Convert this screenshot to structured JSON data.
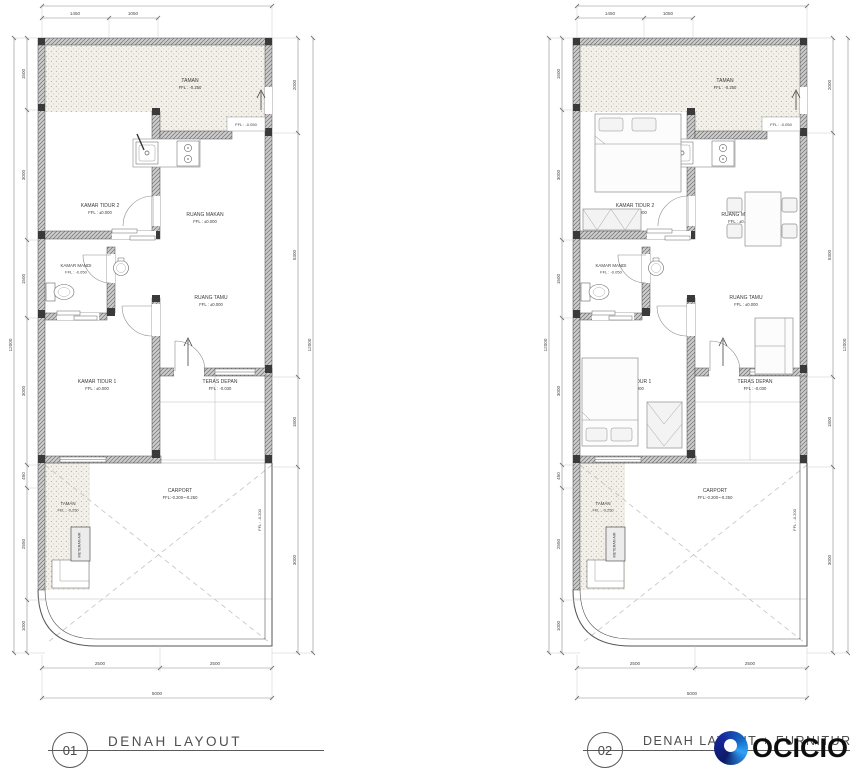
{
  "titles": {
    "plan1": {
      "number": "01",
      "label": "DENAH LAYOUT"
    },
    "plan2": {
      "number": "02",
      "label": "DENAH LAYOUT + FURNITURE"
    }
  },
  "rooms": {
    "taman_rear": {
      "name": "TAMAN",
      "ffl": "FFL : -0.250"
    },
    "kitchen": {
      "ffl_badge": "FFL : -0.050"
    },
    "kamar_tidur_2": {
      "name": "KAMAR TIDUR 2",
      "ffl": "FFL : ±0.000"
    },
    "ruang_makan": {
      "name": "RUANG MAKAN",
      "ffl": "FFL : ±0.000"
    },
    "kamar_mandi": {
      "name": "KAMAR MANDI",
      "ffl": "FFL : -0.050"
    },
    "ruang_tamu": {
      "name": "RUANG TAMU",
      "ffl": "FFL : ±0.000"
    },
    "kamar_tidur_1": {
      "name": "KAMAR TIDUR 1",
      "ffl": "FFL : ±0.000"
    },
    "teras_depan": {
      "name": "TERAS DEPAN",
      "ffl": "FFL : -0.030"
    },
    "taman_front": {
      "name": "TAMAN",
      "ffl": "FFL : -0.250"
    },
    "carport": {
      "name": "CARPORT",
      "ffl": "FFL:-0.200~-0.250",
      "side_ffl": "FFL : -0.200"
    },
    "meteran_air": "METERAN AIR"
  },
  "dimensions": {
    "top": [
      "1450",
      "1050"
    ],
    "left": [
      "1500",
      "3000",
      "1500",
      "3000",
      "450",
      "2550",
      "1000"
    ],
    "left_total": "12000",
    "right": [
      "2000",
      "5300",
      "1800",
      "3000"
    ],
    "right_total": "12000",
    "bottom": [
      "2500",
      "2500"
    ],
    "bottom_total": "5000"
  },
  "watermark": {
    "brand": "OCICIO",
    "logo_navy": "#101f72",
    "logo_blue": "#1e88e5",
    "logo_light": "#2fa3f7"
  },
  "colors": {
    "wall_hatch": "#cdcdcd",
    "garden_dots": "#f2f0e9",
    "line_dark": "#4a4a4a",
    "dim_line": "#8a8a8a"
  }
}
